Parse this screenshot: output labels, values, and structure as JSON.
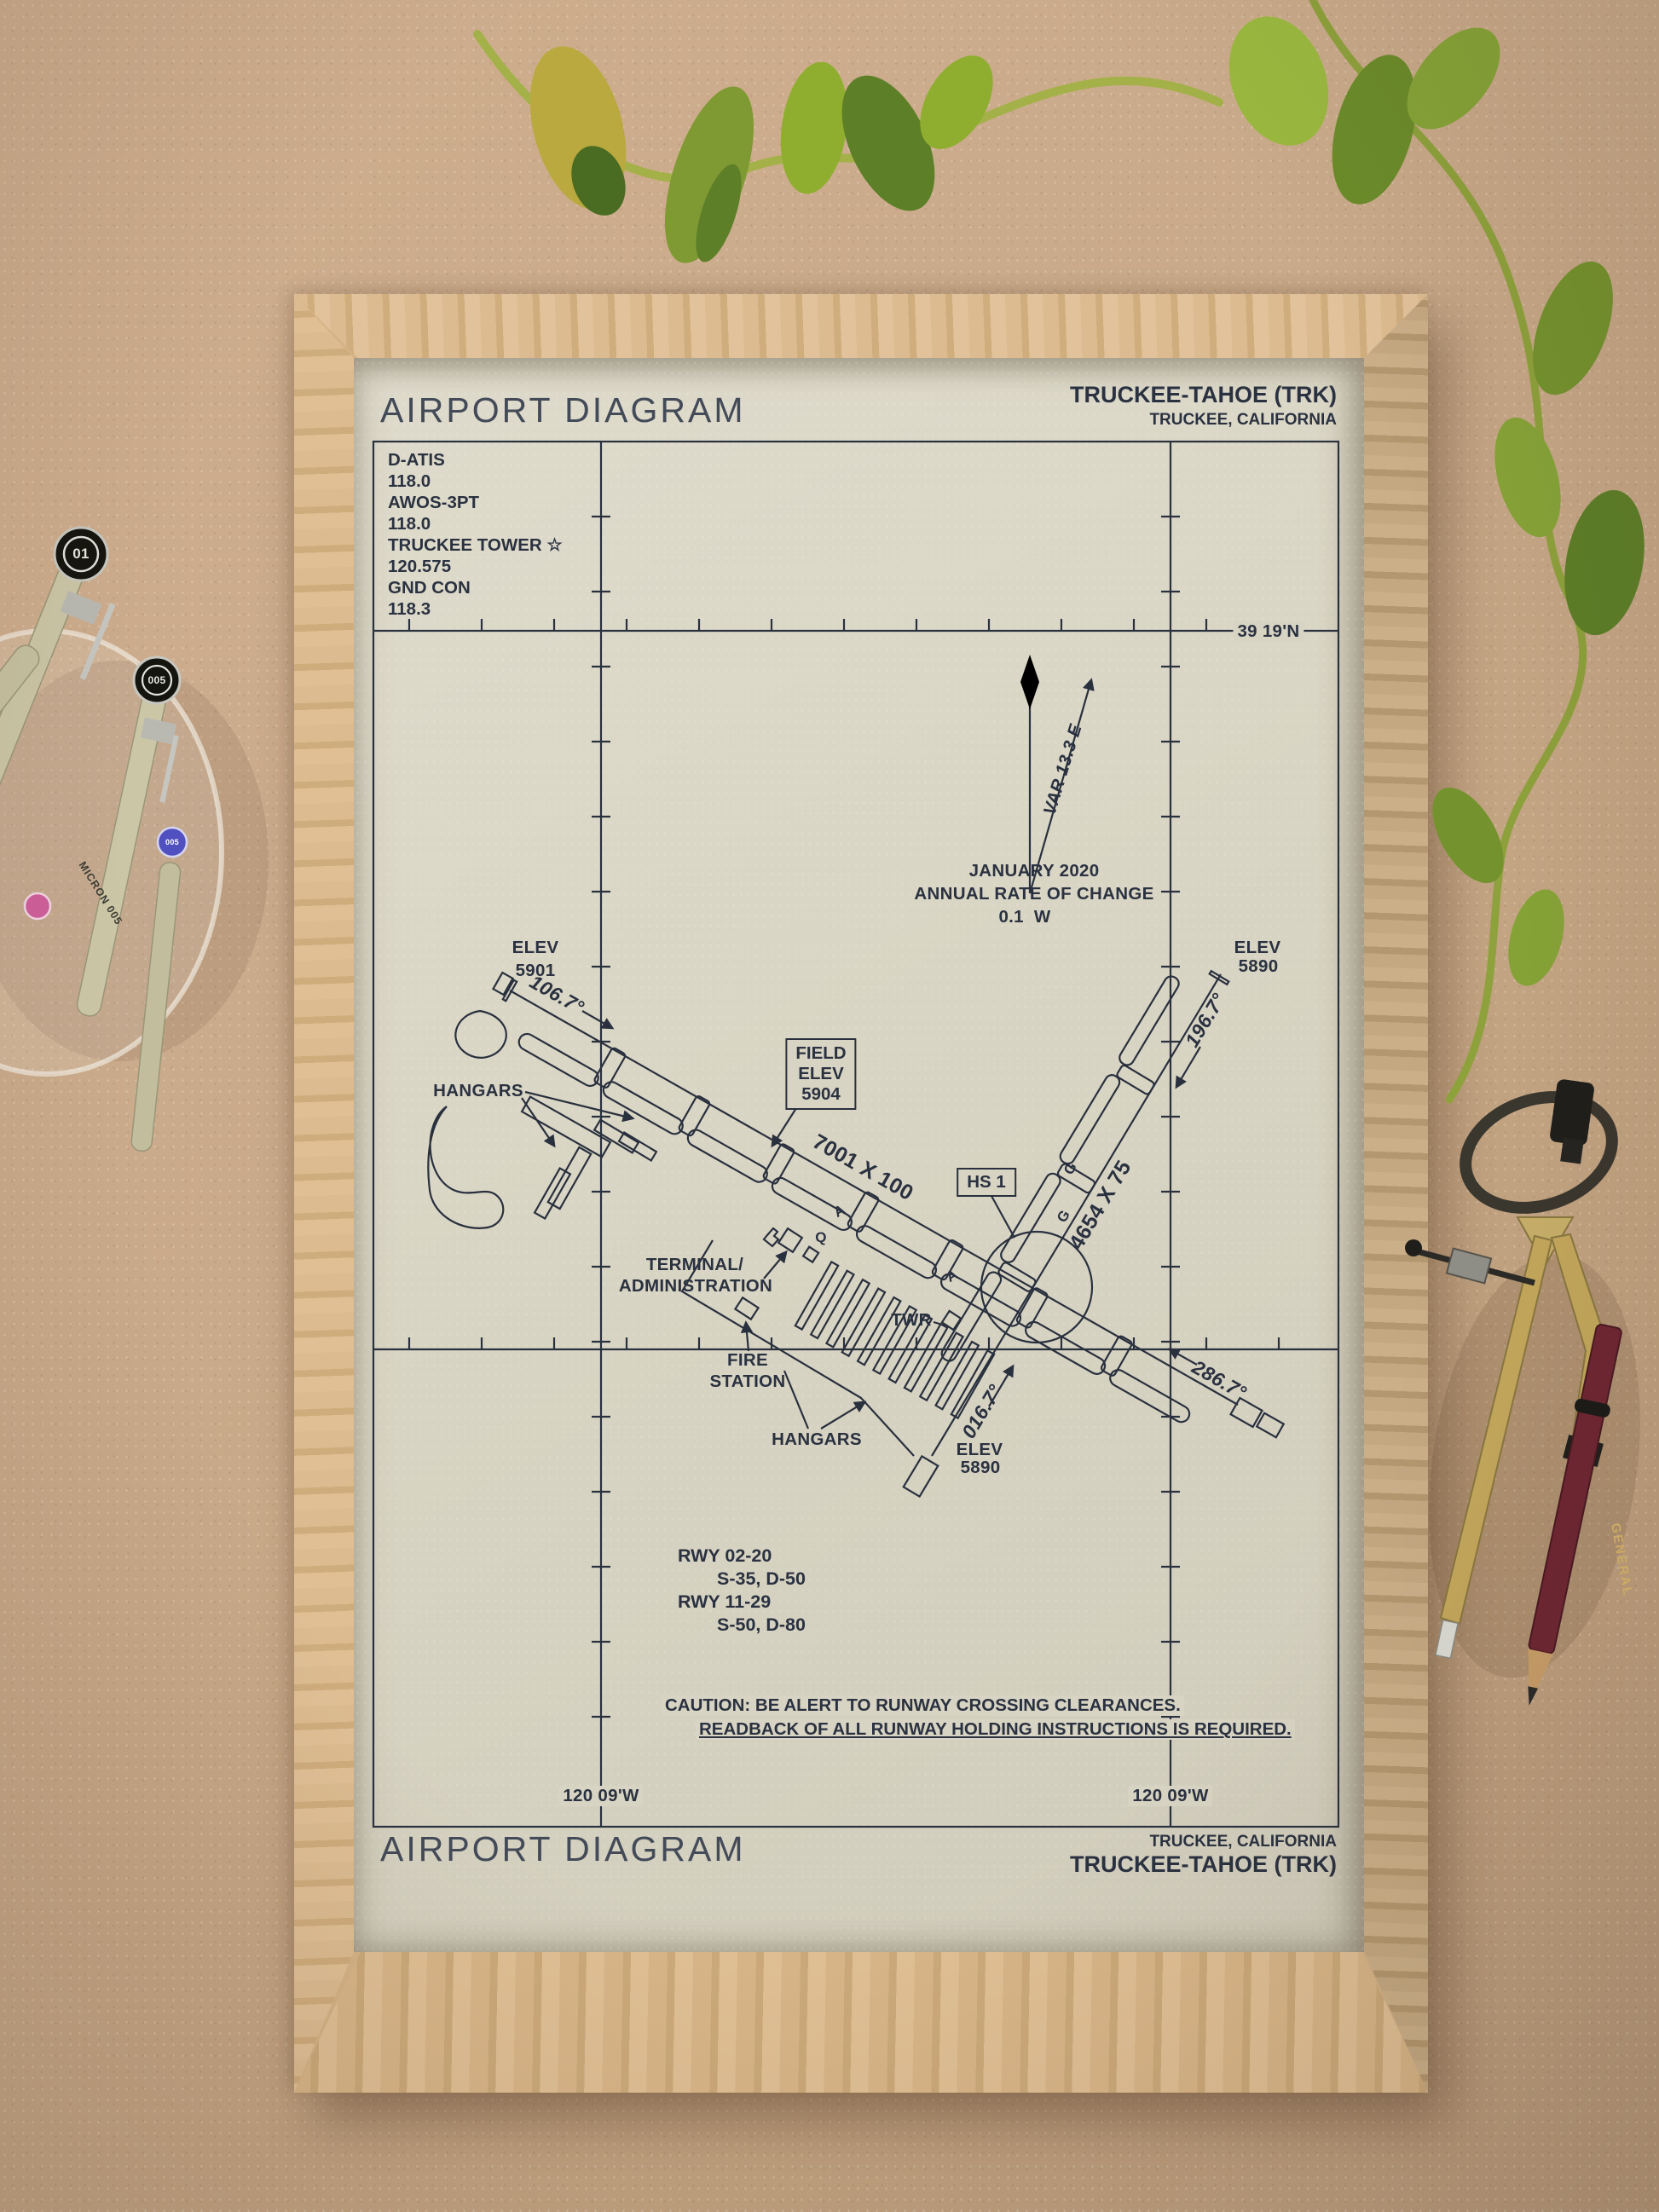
{
  "colors": {
    "ink": "#29303e",
    "paper": "#d9d5c4",
    "cardboard": "#c8a989",
    "frame_oak": "#d5b286",
    "runway_black": "#1e2532",
    "leaf_green": "#86a437",
    "leaf_dark": "#4a6b22",
    "leaf_yellow": "#b9a93f",
    "pen_body": "#cbc6a6",
    "compass_brass": "#c4a85c",
    "pencil_red": "#6e2633"
  },
  "header": {
    "title": "AIRPORT DIAGRAM",
    "airport": "TRUCKEE-TAHOE (TRK)",
    "city": "TRUCKEE, CALIFORNIA"
  },
  "footer": {
    "title": "AIRPORT DIAGRAM",
    "airport": "TRUCKEE-TAHOE (TRK)",
    "city": "TRUCKEE, CALIFORNIA"
  },
  "comms": {
    "l1": "D-ATIS",
    "l2": "118.0",
    "l3": "AWOS-3PT",
    "l4": "118.0",
    "l5": "TRUCKEE TOWER ☆",
    "l6": "120.575",
    "l7": "GND CON",
    "l8": "118.3"
  },
  "grid": {
    "lat": "39 19'N",
    "lon_left": "120 09'W",
    "lon_right": "120 09'W"
  },
  "magvar": {
    "variation": "VAR 13.3 E",
    "date": "JANUARY 2020",
    "rate_label": "ANNUAL RATE OF CHANGE",
    "rate_value": "0.1  W"
  },
  "runway_labels": {
    "r1129_size": "7001 X 100",
    "r0220_size": "4654 X 75",
    "hdg_11": "106.7°",
    "hdg_29": "286.7°",
    "hdg_20": "196.7°",
    "hdg_02": "016.7°"
  },
  "elevations": {
    "rwy11_l1": "ELEV",
    "rwy11_l2": "5901",
    "rwy20_l1": "ELEV",
    "rwy20_l2": "5890",
    "rwy02_l1": "ELEV",
    "rwy02_l2": "5890",
    "field_l1": "FIELD",
    "field_l2": "ELEV",
    "field_l3": "5904"
  },
  "facilities": {
    "hs1": "HS 1",
    "hangars_nw": "HANGARS",
    "hangars_s": "HANGARS",
    "terminal_l1": "TERMINAL/",
    "terminal_l2": "ADMINISTRATION",
    "tower": "TWR",
    "fire_l1": "FIRE",
    "fire_l2": "STATION"
  },
  "taxiway_letters": {
    "a1": "A",
    "q1": "Q",
    "g1": "G",
    "g2": "G",
    "a2": "A"
  },
  "runway_data": {
    "rwy0220": "RWY 02-20",
    "rwy0220_strength": "S-35, D-50",
    "rwy1129": "RWY 11-29",
    "rwy1129_strength": "S-50, D-80"
  },
  "caution": {
    "line1": "CAUTION: BE ALERT TO RUNWAY CROSSING CLEARANCES.",
    "line2": "READBACK OF ALL RUNWAY HOLDING INSTRUCTIONS IS REQUIRED."
  },
  "decor": {
    "pen_cap_01": "01",
    "pen_cap_005": "005",
    "pen_badge_005": "005",
    "pen_brand": "MICRON 005",
    "pencil_brand": "GENERAL"
  }
}
